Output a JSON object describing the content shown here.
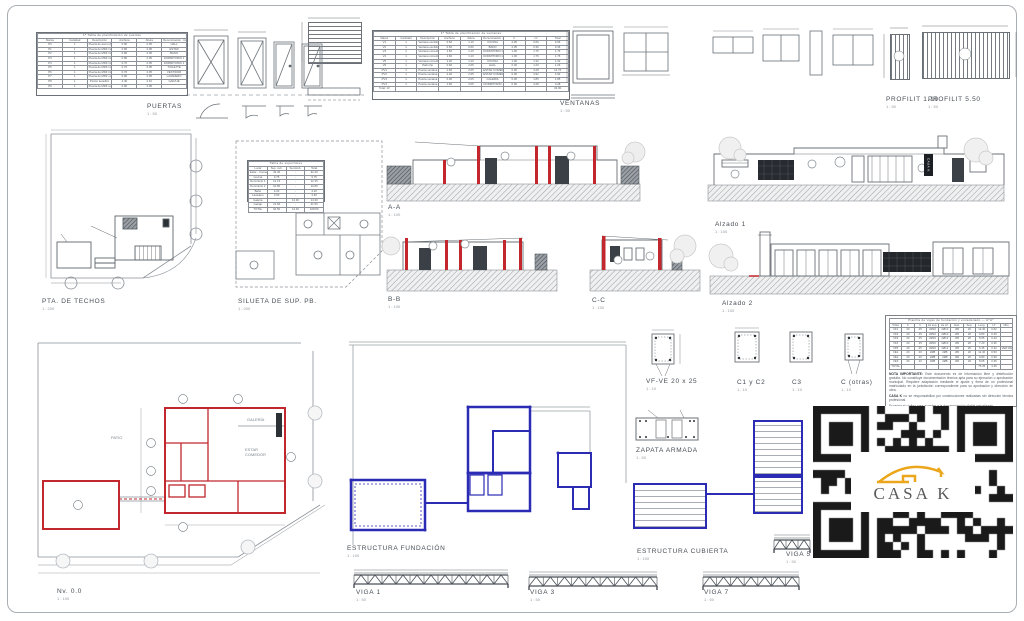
{
  "logo": {
    "text": "CASA K"
  },
  "sections": {
    "puertas": {
      "label": "PUERTAS",
      "scale": "1 : 50"
    },
    "ventanas": {
      "label": "VENTANAS",
      "scale": "1 : 50"
    },
    "profilit110": {
      "label": "PROFILIT 1.10",
      "scale": "1 : 50"
    },
    "profilit550": {
      "label": "PROFILIT 5.50",
      "scale": "1 : 50"
    },
    "pta_techos": {
      "label": "PTA. DE TECHOS",
      "scale": "1 : 200"
    },
    "silueta": {
      "label": "SILUETA DE SUP. PB.",
      "scale": "1 : 200"
    },
    "aa": {
      "label": "A-A",
      "scale": "1 : 100"
    },
    "bb": {
      "label": "B-B",
      "scale": "1 : 100"
    },
    "cc": {
      "label": "C-C",
      "scale": "1 : 100"
    },
    "alzado1": {
      "label": "Alzado 1",
      "scale": "1 : 100"
    },
    "alzado2": {
      "label": "Alzado 2",
      "scale": "1 : 100"
    },
    "nivel0": {
      "label": "Nv. 0.0",
      "scale": "1 : 100"
    },
    "fundacion": {
      "label": "ESTRUCTURA FUNDACIÓN",
      "scale": "1 : 100"
    },
    "cubierta": {
      "label": "ESTRUCTURA CUBIERTA",
      "scale": "1 : 100"
    },
    "vfve": {
      "label": "VF-VE 20 x 25",
      "scale": "1 : 10"
    },
    "c1c2": {
      "label": "C1 y C2",
      "scale": "1 : 10"
    },
    "c3": {
      "label": "C3",
      "scale": "1 : 10"
    },
    "cotras": {
      "label": "C (otras)",
      "scale": "1 : 10"
    },
    "zapata": {
      "label": "ZAPATA ARMADA",
      "scale": "1 : 50"
    },
    "viga1": {
      "label": "VIGA 1",
      "scale": "1 : 50"
    },
    "viga3": {
      "label": "VIGA 3",
      "scale": "1 : 50"
    },
    "viga5": {
      "label": "VIGA 5",
      "scale": "1 : 50"
    },
    "viga7": {
      "label": "VIGA 7",
      "scale": "1 : 50"
    }
  },
  "puertas_table": {
    "title": "1ª Tabla de planificación de puertas",
    "headers": [
      "Marca",
      "Cantidad",
      "Descripción",
      "Anchura",
      "Altura",
      "Denominación - familia"
    ],
    "rows": [
      [
        "P0",
        "1",
        "Puerta de acero (Frentista Básica)",
        "0.90",
        "2.05",
        "HALL"
      ],
      [
        "P1",
        "1",
        "Puerta de MDF interior",
        "0.80",
        "2.05",
        "ESTAR"
      ],
      [
        "P2",
        "1",
        "Puerta de MDF interior",
        "0.80",
        "2.05",
        "BAÑO"
      ],
      [
        "P3",
        "1",
        "Puerta de MDF interior",
        "0.80",
        "2.05",
        "DORMITORIO 1"
      ],
      [
        "P4",
        "1",
        "Puerta de MDF interior",
        "0.70",
        "2.05",
        "DORMITORIO 2"
      ],
      [
        "P5",
        "1",
        "Puerta de MDF interior",
        "0.70",
        "2.05",
        "TOILETTE"
      ],
      [
        "P6",
        "1",
        "Puerta de MDF interior",
        "0.70",
        "2.05",
        "VESTIDOR"
      ],
      [
        "P7",
        "1",
        "Puerta de MDF corrediza",
        "0.90",
        "2.05",
        "LAVADERO"
      ],
      [
        "P8",
        "1",
        "Portón levadizo",
        "2.40",
        "2.10",
        "GARAJE"
      ],
      [
        "P9",
        "1",
        "Puerta de MDF exterior",
        "0.90",
        "2.05",
        ""
      ]
    ]
  },
  "ventanas_table": {
    "title": "1ª Tabla de planificación de ventanas",
    "headers": [
      "Marca",
      "Cantidad",
      "Descripción",
      "Anchura",
      "Altura",
      "Denominación - Nombre",
      "h",
      "m²",
      "Total"
    ],
    "rows": [
      [
        "V1",
        "1",
        "Ventana oscilobatiente",
        "0.60",
        "1.10",
        "COCINA",
        "2.05",
        "0.66",
        "0.66"
      ],
      [
        "V2",
        "1",
        "Ventana oscilobatiente",
        "0.60",
        "0.60",
        "BAÑO",
        "2.05",
        "0.36",
        "0.36"
      ],
      [
        "V3",
        "1",
        "Ventana corrediza",
        "1.60",
        "1.10",
        "DORMITORIO 1",
        "1.00",
        "1.76",
        "1.76"
      ],
      [
        "V4",
        "1",
        "Ventana corrediza",
        "1.60",
        "1.10",
        "DORMITORIO 2",
        "1.00",
        "1.76",
        "1.76"
      ],
      [
        "V5",
        "1",
        "Ventana corrediza",
        "1.20",
        "1.10",
        "COCINA",
        "1.00",
        "1.32",
        "1.32"
      ],
      [
        "V6",
        "1",
        "Paño fijo",
        "0.60",
        "2.05",
        "HALL",
        "0.00",
        "1.23",
        "1.23"
      ],
      [
        "PV1",
        "1",
        "Puerta ventana de 2 hojas",
        "1.60",
        "2.05",
        "ESTAR COMEDOR",
        "0.00",
        "3.28",
        "14.76"
      ],
      [
        "PV2",
        "1",
        "Puerta ventana de 2 hojas",
        "2.40",
        "2.05",
        "ESTAR COMEDOR",
        "0.00",
        "4.92",
        "4.92"
      ],
      [
        "PV3",
        "1",
        "Puerta ventana de 1 hoja",
        "0.90",
        "2.05",
        "GALERÍA",
        "0.00",
        "1.85",
        "1.85"
      ],
      [
        "PV4",
        "1",
        "Puerta ventana de 2 hojas",
        "1.60",
        "2.05",
        "DORMITORIO",
        "0.00",
        "3.28",
        "3.28"
      ],
      [
        "Total: 13",
        "",
        "",
        "",
        "",
        "",
        "",
        "",
        "32.90"
      ]
    ]
  },
  "silueta_table": {
    "title": "Tabla de superficies",
    "headers": [
      "Local",
      "Sup. cub.",
      "Semicub.",
      "Total"
    ],
    "rows": [
      [
        "Estar - Comedor",
        "32.40",
        "-",
        "32.40"
      ],
      [
        "Cocina",
        "9.75",
        "-",
        "9.75"
      ],
      [
        "Dormitorio 1",
        "12.15",
        "-",
        "12.15"
      ],
      [
        "Dormitorio 2",
        "10.80",
        "-",
        "10.80"
      ],
      [
        "Baño",
        "4.20",
        "-",
        "4.20"
      ],
      [
        "Lavadero",
        "3.60",
        "-",
        "3.60"
      ],
      [
        "Galería",
        "-",
        "14.30",
        "14.30"
      ],
      [
        "Garaje",
        "21.60",
        "-",
        "21.60"
      ],
      [
        "TOTAL",
        "94.50",
        "14.30",
        "108.80"
      ]
    ]
  },
  "armado_table": {
    "title": "Planilla de vigas de fundación y encadenado — HºAº",
    "headers": [
      "VIGA",
      "b",
      "h",
      "As sup.",
      "As inf.",
      "Estr.",
      "Sep.",
      "Long.",
      "Hº",
      "Obs."
    ],
    "rows": [
      [
        "VF1",
        "20",
        "25",
        "2Ø10",
        "2Ø10",
        "Ø6",
        "20",
        "12.40",
        "0.62",
        ""
      ],
      [
        "VF2",
        "20",
        "25",
        "2Ø10",
        "2Ø10",
        "Ø6",
        "20",
        "9.80",
        "0.49",
        ""
      ],
      [
        "VF3",
        "20",
        "25",
        "2Ø10",
        "2Ø12",
        "Ø6",
        "20",
        "8.65",
        "0.43",
        ""
      ],
      [
        "VF4",
        "20",
        "25",
        "2Ø10",
        "2Ø10",
        "Ø6",
        "20",
        "7.20",
        "0.36",
        ""
      ],
      [
        "VF5",
        "20",
        "25",
        "2Ø10",
        "2Ø12",
        "Ø6",
        "20",
        "6.45",
        "0.32",
        "VER DETALLE"
      ],
      [
        "VE1",
        "20",
        "20",
        "2Ø8",
        "2Ø8",
        "Ø6",
        "20",
        "12.40",
        "0.50",
        ""
      ],
      [
        "VE2",
        "20",
        "20",
        "2Ø8",
        "2Ø8",
        "Ø6",
        "20",
        "9.80",
        "0.39",
        ""
      ],
      [
        "VE3",
        "20",
        "20",
        "2Ø8",
        "2Ø8",
        "Ø6",
        "20",
        "8.65",
        "0.35",
        ""
      ],
      [
        "TOTAL",
        "",
        "",
        "",
        "",
        "",
        "",
        "75.35",
        "3.46",
        ""
      ]
    ]
  },
  "notes": {
    "n1_prefix": "NOTA IMPORTANTE: ",
    "n1_body": "Este documento es de información libre y distribución gratuita. No constituye documentación técnica apta para su ejecución o aprobación municipal. Requiere adaptación mediante el ajuste y firma de un profesional matriculado en la jurisdicción correspondiente para su aprobación y dirección de obra.",
    "n2_prefix": "CASA K ",
    "n2_body": "no se responsabiliza por construcciones realizadas sin dirección técnica profesional.",
    "n3": "Escaneá el código para acceder a la documentación digital actualizada."
  },
  "plan_labels": {
    "patio": "PATIO",
    "galeria": "GALERÍA",
    "estar1": "ESTAR",
    "estar2": "COMEDOR"
  }
}
